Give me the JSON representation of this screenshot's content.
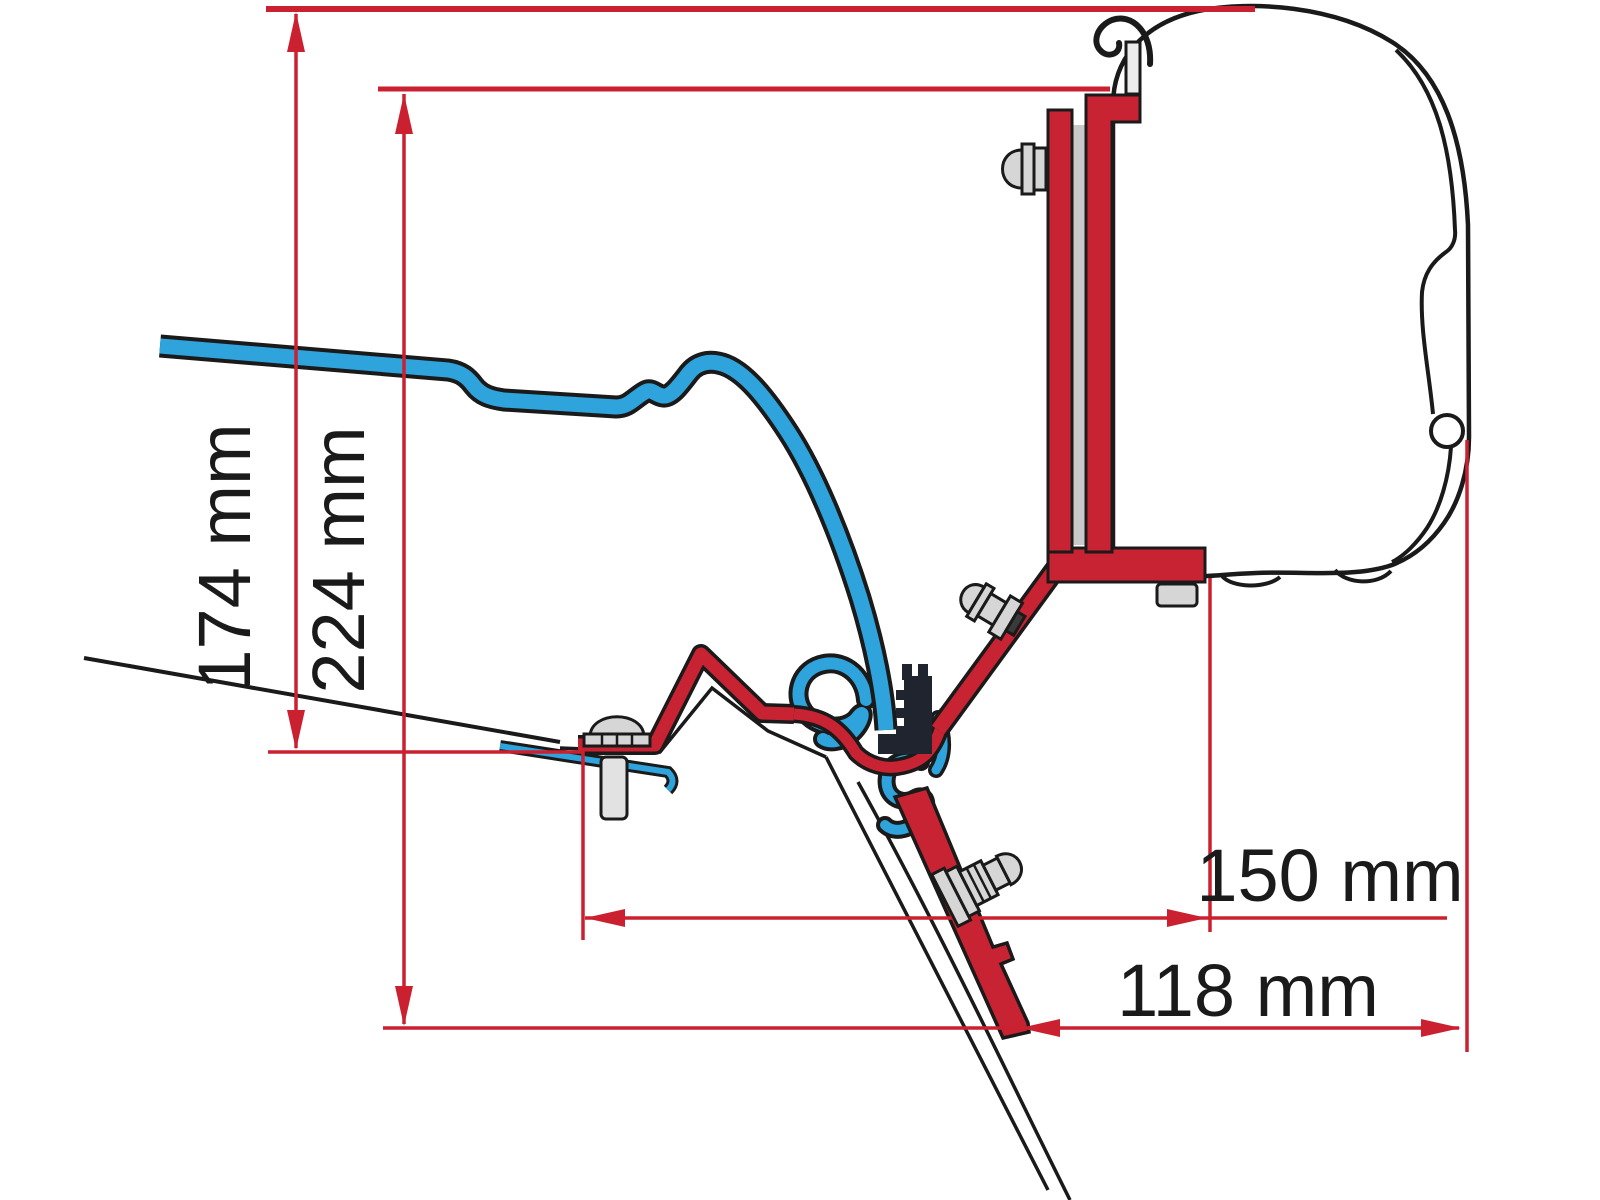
{
  "diagram": {
    "type": "technical-dimension-drawing",
    "dimensions": {
      "d174": {
        "label": "174 mm"
      },
      "d224": {
        "label": "224 mm"
      },
      "d150": {
        "label": "150 mm"
      },
      "d118": {
        "label": "118 mm"
      }
    },
    "parts": [
      "van-roof-line",
      "roof-rail-profile-blue",
      "adapter-bracket-red",
      "clamp-block",
      "awning-case",
      "awning-hook",
      "mounting-bolts"
    ],
    "colors": {
      "dimension_red": "#CB2030",
      "bracket_red": "#C82332",
      "rail_blue": "#2FA3DC",
      "outline_black": "#1a1a1a",
      "metal_gray": "#D6D6D6",
      "background": "#ffffff"
    }
  }
}
